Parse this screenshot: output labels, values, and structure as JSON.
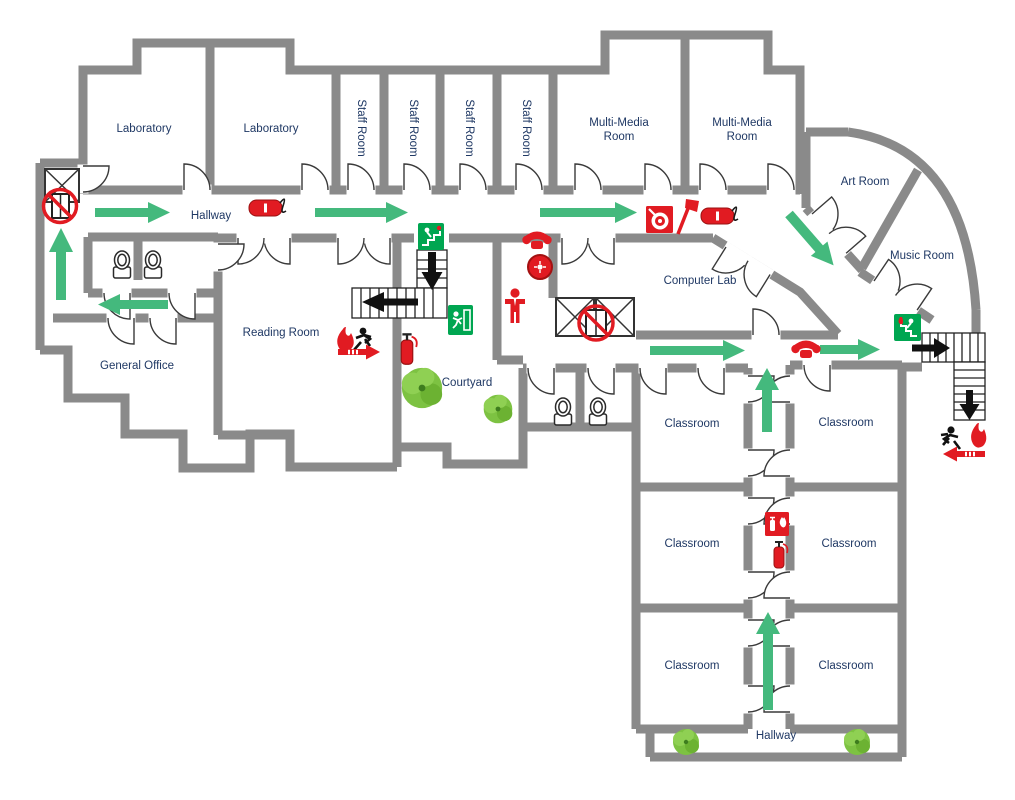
{
  "rooms": {
    "laboratory_1": "Laboratory",
    "laboratory_2": "Laboratory",
    "staff_room_1": "Staff Room",
    "staff_room_2": "Staff Room",
    "staff_room_3": "Staff Room",
    "staff_room_4": "Staff Room",
    "multi_media_room_1": "Multi-Media Room",
    "multi_media_room_2": "Multi-Media Room",
    "art_room": "Art Room",
    "music_room": "Music Room",
    "computer_lab": "Computer Lab",
    "reading_room": "Reading Room",
    "general_office": "General Office",
    "courtyard": "Courtyard",
    "hallway_top": "Hallway",
    "hallway_bottom": "Hallway",
    "classroom_1": "Classroom",
    "classroom_2": "Classroom",
    "classroom_3": "Classroom",
    "classroom_4": "Classroom",
    "classroom_5": "Classroom",
    "classroom_6": "Classroom"
  },
  "colors": {
    "wall": "#8a8a8a",
    "room_label": "#1f3864",
    "evacuation_arrow_green": "#44b97d",
    "safety_red": "#e11b22",
    "exit_sign_green": "#00a651",
    "plant_green": "#7dc242",
    "stair_outline": "#222222"
  },
  "icons": {
    "no_elevator_icon": "elevator doors crossed by red prohibition circle",
    "elevator_shaft_icon": "square with X cross",
    "evacuation_arrow_icon": "solid green block arrow",
    "exit_sign_icon": "green square with white running man and door",
    "exit_stairs_sign_icon": "green square with man descending stairs",
    "fire_extinguisher_icon": "red extinguisher cylinder",
    "fire_extinguisher_sign_icon": "red square with extinguisher and flame",
    "fire_hose_icon": "red hose cylinder with black hose",
    "fire_hose_reel_sign_icon": "red square with white spiral reel",
    "fire_axe_icon": "red fire axe",
    "fire_alarm_bell_icon": "red alarm bell disc",
    "emergency_phone_icon": "red telephone handset",
    "evacuee_person_icon": "red standing person",
    "emergency_exit_run_icon": "running man with flame and red exit arrow",
    "stairs_icon": "stair treads with black direction arrow",
    "toilet_icon": "toilet seat symbol",
    "plant_icon": "green shrub",
    "door_icon": "door leaf with quarter-circle swing"
  }
}
